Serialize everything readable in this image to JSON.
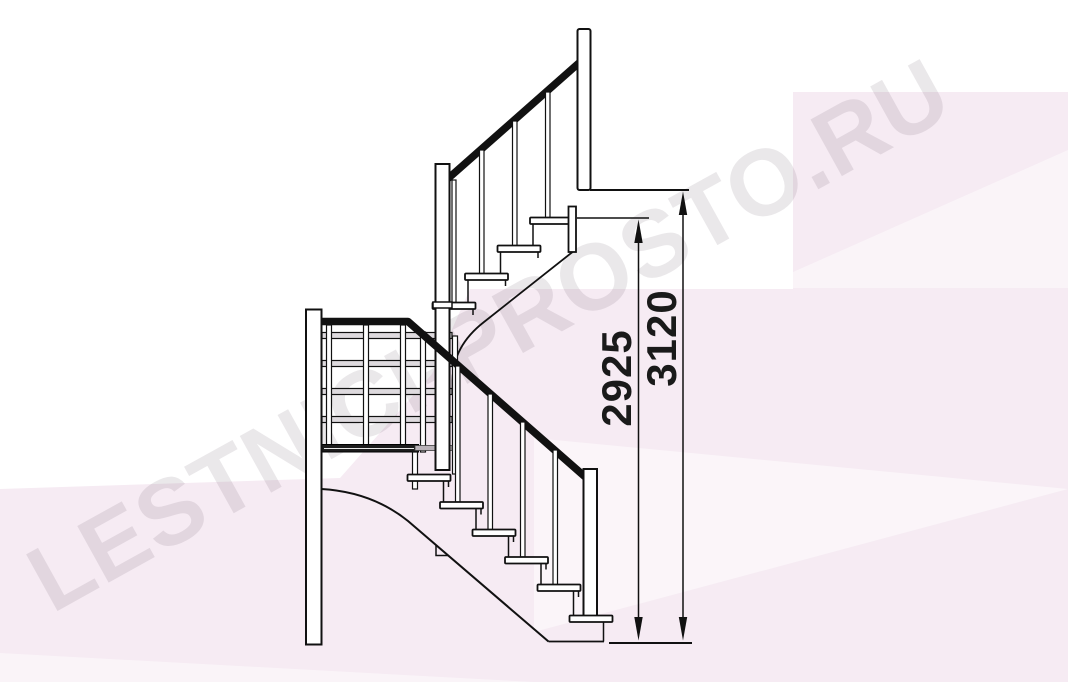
{
  "watermark": {
    "text": "LESTNICI-PROSTO.RU"
  },
  "dimensions": {
    "partial_height": {
      "label": "2925"
    },
    "total_height": {
      "label": "3120"
    }
  },
  "colors": {
    "line": "#1a1a1a",
    "background": "#ffffff",
    "pink_tint": "#f6ebf3",
    "rail_gray": "#dedade",
    "dark_bar": "#1c1c1c",
    "connector_gray": "#b9b2b8",
    "watermark": "#5a4f5c",
    "dimension_text": "#1a1a1a"
  }
}
